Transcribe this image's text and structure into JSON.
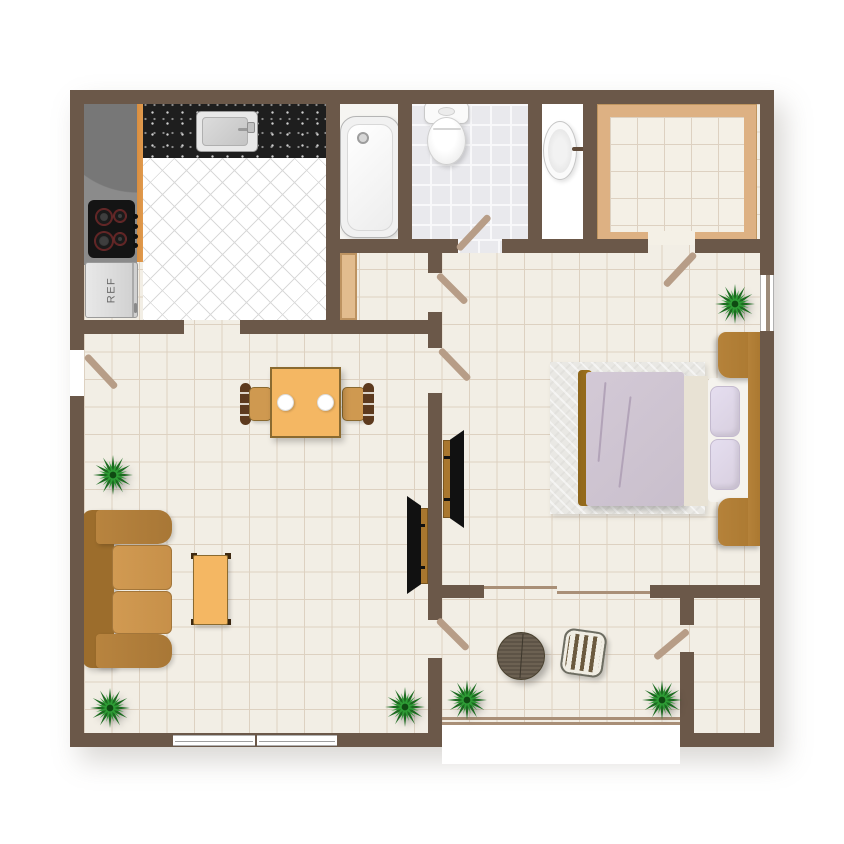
{
  "labels": {
    "refrigerator": "REF"
  },
  "colors": {
    "wall": "#6b5849",
    "floor": "#f2eee5",
    "floor_grid": "#ddd1c1",
    "kitchen_floor": "#ffffff",
    "kitchen_floor_line": "#d9d9d9",
    "bath_tile": "#e9e9ed",
    "bath_tile_line": "#f8f8fa",
    "closet_trim": "#ddb183",
    "closet_floor": "#f4f0e6",
    "door_swing": "#b79d87",
    "counter_black": "#1e1e1e",
    "counter_gray": "#808080",
    "counter_edge": "#e09a4e",
    "wood": "#a9772f",
    "wood_dark": "#5d3a1e",
    "sofa": "#b8843f",
    "sofa_back": "#9c6d2c",
    "sofa_cushion": "#c79049",
    "table_top": "#f4b763",
    "table_border": "#8a6a30",
    "chair_seat": "#cf9950",
    "bed_blanket": "#c9bfcc",
    "bed_sheet": "#e8e2d4",
    "pillow": "#d8cfdf",
    "mattress": "#f5f3ee",
    "rug": "#e9e8e4",
    "tv": "#111111",
    "plant_dark": "#1c6b20",
    "plant_light": "#2e9c35",
    "plant_core": "#0f4a12",
    "wicker": "#5e5549",
    "fixture": "#fafafa"
  },
  "rooms": [
    "kitchen",
    "bathroom",
    "wash-basin-niche",
    "walk-in-closet",
    "hallway",
    "living-dining-room",
    "bedroom",
    "balcony-nook",
    "storage-room"
  ],
  "inventory": {
    "kitchen": [
      "corner-counter",
      "black-countertop",
      "sink",
      "stove-4-burners",
      "refrigerator"
    ],
    "bathroom": [
      "bathtub",
      "toilet",
      "pedestal-sink"
    ],
    "living_room": [
      "sofa",
      "dining-table-2-plates",
      "dining-chair-left",
      "dining-chair-right",
      "ottoman",
      "tv-unit"
    ],
    "bedroom": [
      "double-bed",
      "pillow-x2",
      "headboard-with-nightstands",
      "rug",
      "tv-unit"
    ],
    "balcony_nook": [
      "round-wicker-table",
      "slatted-chair"
    ],
    "plants": 6,
    "windows": 3,
    "door_swings": 7,
    "sliding_doors": 2
  }
}
